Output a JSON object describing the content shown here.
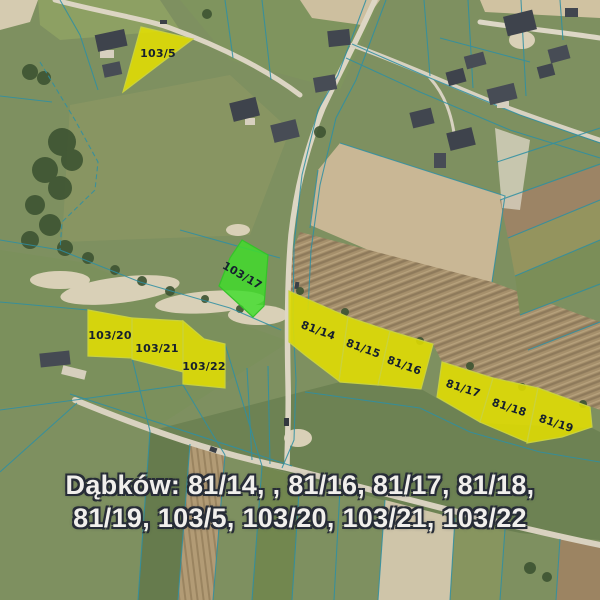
{
  "map": {
    "place_name": "Dąbków",
    "caption": {
      "line1": "Dąbków: 81/14, , 81/16, 81/17, 81/18,",
      "line2": "81/19, 103/5, 103/20, 103/21, 103/22",
      "text_color": "#f1efec",
      "outline_color": "#272c37"
    },
    "colors": {
      "parcel_yellow": "#e4e000",
      "parcel_green": "#3fdd2b",
      "parcel_stroke_yellow": "#c9d23e",
      "parcel_stroke_green": "#35c22a",
      "parcel_label": "#16202e",
      "cadastral_line": "#2e8fa3"
    },
    "parcels": [
      {
        "id": "103/5",
        "label": "103/5",
        "highlight": "yellow",
        "points": "141,27 193,39 165,60 123,92",
        "label_x": 158,
        "label_y": 54,
        "label_rotation": 0
      },
      {
        "id": "103/17",
        "label": "103/17",
        "highlight": "green",
        "points": "242,240 268,255 264,306 253,317 219,286 230,258",
        "label_x": 242,
        "label_y": 276,
        "label_rotation": 30
      },
      {
        "id": "103/20",
        "label": "103/20",
        "highlight": "yellow",
        "points": "88,310 132,318 132,358 88,356",
        "label_x": 110,
        "label_y": 336,
        "label_rotation": 0
      },
      {
        "id": "103/21",
        "label": "103/21",
        "highlight": "yellow",
        "points": "132,318 183,321 183,372 132,359",
        "label_x": 157,
        "label_y": 349,
        "label_rotation": 0
      },
      {
        "id": "103/22",
        "label": "103/22",
        "highlight": "yellow",
        "points": "183,321 204,339 225,344 225,388 183,384",
        "label_x": 204,
        "label_y": 367,
        "label_rotation": 0
      },
      {
        "id": "81/14",
        "label": "81/14",
        "highlight": "yellow",
        "points": "289,291 348,317 339,381 305,355 289,342",
        "label_x": 318,
        "label_y": 331,
        "label_rotation": 20
      },
      {
        "id": "81/15",
        "label": "81/15",
        "highlight": "yellow",
        "points": "348,317 390,331 378,385 340,382 339,381",
        "label_x": 363,
        "label_y": 349,
        "label_rotation": 20
      },
      {
        "id": "81/16",
        "label": "81/16",
        "highlight": "yellow",
        "points": "390,331 433,344 421,389 380,385 378,385",
        "label_x": 404,
        "label_y": 366,
        "label_rotation": 20
      },
      {
        "id": "81/17",
        "label": "81/17",
        "highlight": "yellow",
        "points": "442,362 493,378 480,422 437,397",
        "label_x": 463,
        "label_y": 389,
        "label_rotation": 18
      },
      {
        "id": "81/18",
        "label": "81/18",
        "highlight": "yellow",
        "points": "493,378 538,388 527,442 480,422",
        "label_x": 509,
        "label_y": 408,
        "label_rotation": 18
      },
      {
        "id": "81/19",
        "label": "81/19",
        "highlight": "yellow",
        "points": "538,388 590,407 592,427 562,437 527,443",
        "label_x": 556,
        "label_y": 424,
        "label_rotation": 18
      }
    ]
  }
}
